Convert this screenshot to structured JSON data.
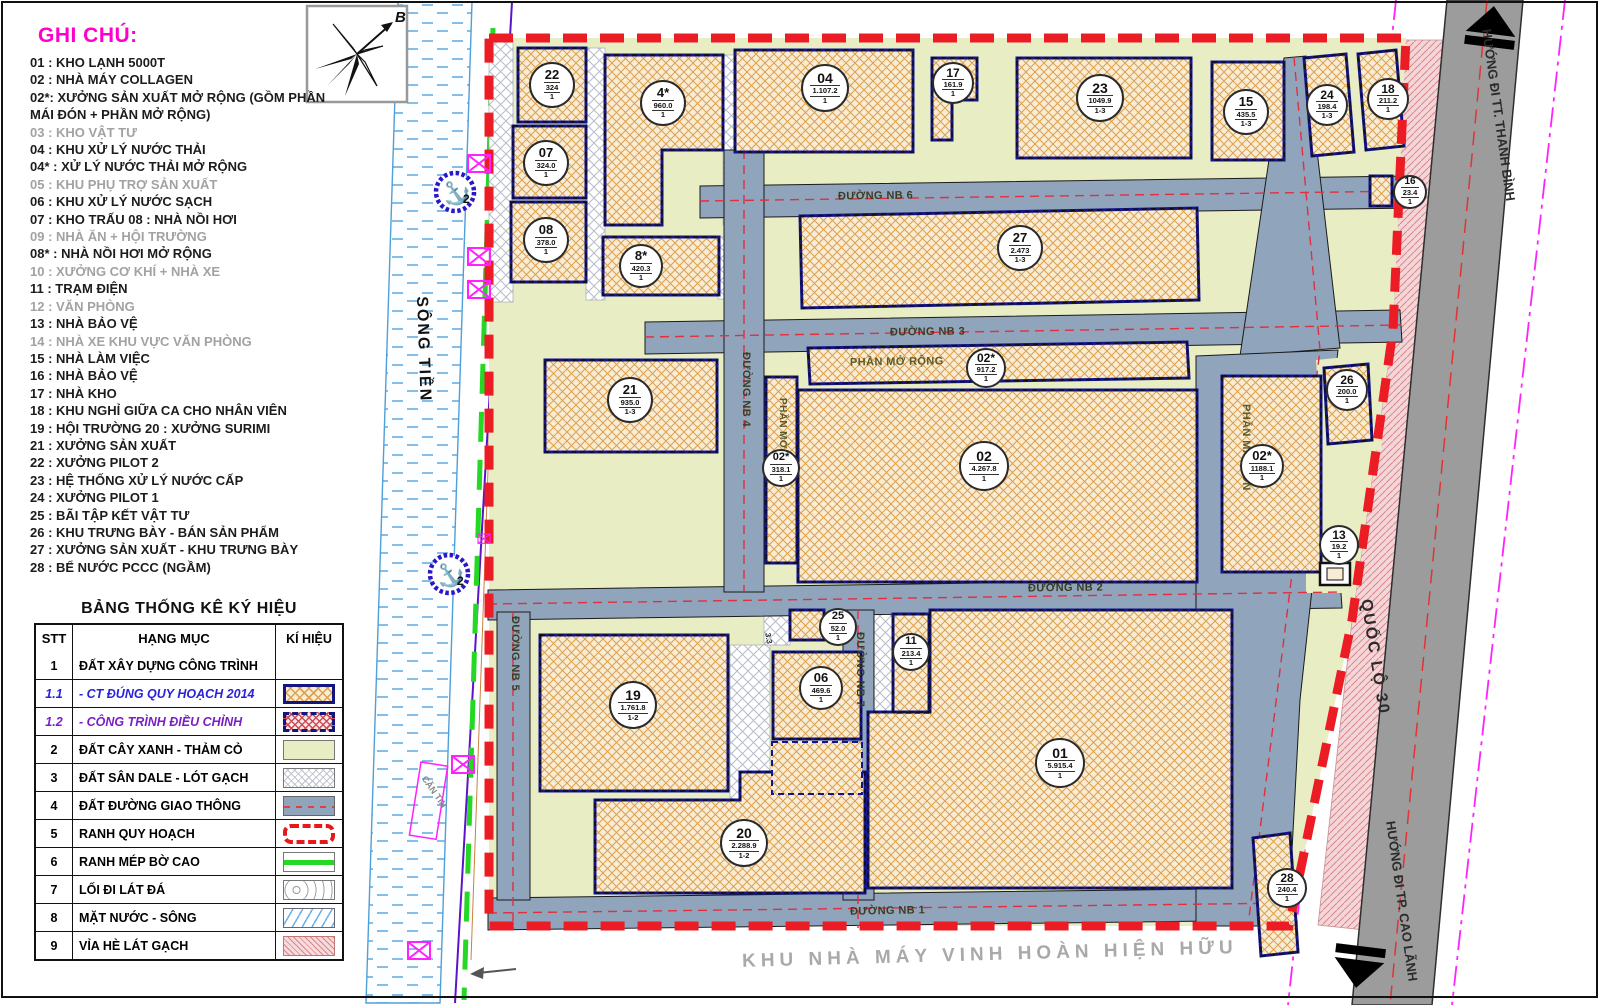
{
  "legend": {
    "title": "GHI CHÚ:",
    "items": [
      {
        "text": "01 : KHO LẠNH 5000T",
        "muted": false
      },
      {
        "text": "02 : NHÀ MÁY COLLAGEN",
        "muted": false
      },
      {
        "text": "02*: XƯỞNG SẢN XUẤT MỞ RỘNG (GỒM PHẦN MÁI ĐÓN + PHẦN MỞ RỘNG)",
        "muted": false
      },
      {
        "text": "03 : KHO VẬT TƯ",
        "muted": true
      },
      {
        "text": "04 : KHU XỬ LÝ NƯỚC THẢI",
        "muted": false
      },
      {
        "text": "04* : XỬ LÝ NƯỚC THẢI MỞ RỘNG",
        "muted": false
      },
      {
        "text": "05 : KHU PHỤ TRỢ SẢN XUẤT",
        "muted": true
      },
      {
        "text": "06 : KHU XỬ LÝ NƯỚC SẠCH",
        "muted": false
      },
      {
        "text": "07 : KHO TRẤU 08 : NHÀ NỒI HƠI",
        "muted": false
      },
      {
        "text": "09 : NHÀ ĂN + HỘI TRƯỜNG",
        "muted": true
      },
      {
        "text": "08* : NHÀ NỒI HƠI MỞ RỘNG",
        "muted": false
      },
      {
        "text": "10 : XƯỞNG CƠ KHÍ + NHÀ XE",
        "muted": true
      },
      {
        "text": "11 : TRẠM ĐIỆN",
        "muted": false
      },
      {
        "text": "12 : VĂN PHÒNG",
        "muted": true
      },
      {
        "text": "13 : NHÀ BẢO VỆ",
        "muted": false
      },
      {
        "text": "14 : NHÀ XE KHU VỰC VĂN PHÒNG",
        "muted": true
      },
      {
        "text": "15 : NHÀ LÀM VIỆC",
        "muted": false
      },
      {
        "text": "16 : NHÀ BẢO VỆ",
        "muted": false
      },
      {
        "text": "17 : NHÀ KHO",
        "muted": false
      },
      {
        "text": "18 : KHU NGHỈ GIỮA CA CHO NHÂN VIÊN",
        "muted": false
      },
      {
        "text": "19 : HỘI TRƯỜNG 20 : XƯỞNG SURIMI",
        "muted": false
      },
      {
        "text": "21 : XƯỞNG SẢN XUẤT",
        "muted": false
      },
      {
        "text": "22 : XƯỞNG PILOT 2",
        "muted": false
      },
      {
        "text": "23 : HỆ THỐNG XỬ LÝ NƯỚC CẤP",
        "muted": false
      },
      {
        "text": "24 : XƯỞNG PILOT 1",
        "muted": false
      },
      {
        "text": "25 : BÃI TẬP KẾT VẬT TƯ",
        "muted": false
      },
      {
        "text": "26 : KHU TRƯNG BÀY - BÁN SẢN PHẨM",
        "muted": false
      },
      {
        "text": "27 : XƯỞNG SẢN XUẤT - KHU TRƯNG BÀY",
        "muted": false
      },
      {
        "text": "28 : BỂ NƯỚC PCCC (NGẦM)",
        "muted": false
      }
    ]
  },
  "table": {
    "title": "BẢNG THỐNG KÊ KÝ HIỆU",
    "headers": {
      "stt": "STT",
      "hangmuc": "HẠNG MỤC",
      "kihieu": "KÍ HIỆU"
    },
    "rows": [
      {
        "stt": "1",
        "label": "ĐẤT XÂY DỰNG CÔNG TRÌNH",
        "swatch": "none",
        "style": ""
      },
      {
        "stt": "1.1",
        "label": "- CT ĐÚNG QUY HOẠCH 2014",
        "swatch": "tan",
        "style": "blue-italic"
      },
      {
        "stt": "1.2",
        "label": "- CÔNG TRÌNH ĐIỀU CHỈNH",
        "swatch": "red",
        "style": "purple-italic"
      },
      {
        "stt": "2",
        "label": "ĐẤT CÂY XANH - THẢM CỎ",
        "swatch": "green",
        "style": ""
      },
      {
        "stt": "3",
        "label": "ĐẤT SÂN DALE - LÓT GẠCH",
        "swatch": "gray",
        "style": ""
      },
      {
        "stt": "4",
        "label": "ĐẤT ĐƯỜNG GIAO THÔNG",
        "swatch": "road",
        "style": ""
      },
      {
        "stt": "5",
        "label": "RANH QUY HOẠCH",
        "swatch": "dash",
        "style": ""
      },
      {
        "stt": "6",
        "label": "RANH MÉP BỜ CAO",
        "swatch": "gline",
        "style": ""
      },
      {
        "stt": "7",
        "label": "LỐI ĐI LÁT ĐÁ",
        "swatch": "stone",
        "style": ""
      },
      {
        "stt": "8",
        "label": "MẶT NƯỚC - SÔNG",
        "swatch": "water",
        "style": ""
      },
      {
        "stt": "9",
        "label": "VỈA HÈ LÁT GẠCH",
        "swatch": "pink",
        "style": ""
      }
    ]
  },
  "buildings": [
    {
      "id": "22",
      "area": "324",
      "floors": "1"
    },
    {
      "id": "07",
      "area": "324.0",
      "floors": "1"
    },
    {
      "id": "08",
      "area": "378.0",
      "floors": "1"
    },
    {
      "id": "4*",
      "area": "960.0",
      "floors": "1"
    },
    {
      "id": "8*",
      "area": "420.3",
      "floors": "1"
    },
    {
      "id": "04",
      "area": "1.107.2",
      "floors": "1"
    },
    {
      "id": "17",
      "area": "161.9",
      "floors": "1"
    },
    {
      "id": "23",
      "area": "1049.9",
      "floors": "1-3"
    },
    {
      "id": "15",
      "area": "435.5",
      "floors": "1-3"
    },
    {
      "id": "24",
      "area": "198.4",
      "floors": "1-3"
    },
    {
      "id": "18",
      "area": "211.2",
      "floors": "1"
    },
    {
      "id": "16",
      "area": "23.4",
      "floors": "1"
    },
    {
      "id": "27",
      "area": "2.473",
      "floors": "1-3"
    },
    {
      "id": "02*",
      "area": "917.2",
      "floors": "1"
    },
    {
      "id": "21",
      "area": "935.0",
      "floors": "1-3"
    },
    {
      "id": "02*",
      "area": "318.1",
      "floors": "1"
    },
    {
      "id": "02",
      "area": "4.267.8",
      "floors": "1"
    },
    {
      "id": "02*",
      "area": "1188.1",
      "floors": "1"
    },
    {
      "id": "26",
      "area": "200.0",
      "floors": "1"
    },
    {
      "id": "13",
      "area": "19.2",
      "floors": "1"
    },
    {
      "id": "25",
      "area": "52.0",
      "floors": "1"
    },
    {
      "id": "11",
      "area": "213.4",
      "floors": "1"
    },
    {
      "id": "06",
      "area": "469.6",
      "floors": "1"
    },
    {
      "id": "19",
      "area": "1.761.8",
      "floors": "1-2"
    },
    {
      "id": "20",
      "area": "2.288.9",
      "floors": "1-2"
    },
    {
      "id": "01",
      "area": "5.915.4",
      "floors": "1"
    },
    {
      "id": "28",
      "area": "240.4",
      "floors": "1"
    }
  ],
  "roads": {
    "nb1": "ĐƯỜNG NB 1",
    "nb2": "ĐƯỜNG NB 2",
    "nb3": "ĐƯỜNG NB 3",
    "nb4": "ĐƯỜNG NB 4",
    "nb5": "ĐƯỜNG NB 5",
    "nb6": "ĐƯỜNG NB 6",
    "nb7": "ĐƯỜNG NB 7"
  },
  "plan": {
    "north": "B",
    "river": "SÔNG TIỀN",
    "highway": "QUỐC LỘ 30",
    "dir_north": "HƯỚNG ĐI TT. THANH BÌNH",
    "dir_south": "HƯỚNG ĐI TP. CAO LÃNH",
    "existing": "KHU NHÀ MÁY VINH HOÀN HIỆN HỮU",
    "extension_top": "PHẦN MỞ RỘNG",
    "extension_left": "PHẦN MỞ RỘNG",
    "canopy": "PHẦN MÁI ĐÓN",
    "canteen": "CĂN TIN",
    "anchor_no": "2",
    "small_mark": "3.3"
  },
  "colors": {
    "green_land": "#e8edc3",
    "road": "#90a4bc",
    "building_fill": "#f8ecd4",
    "building_hatch": "#dca04e",
    "building_stroke": "#15158a",
    "boundary_red": "#ec1c24",
    "highway_gray": "#9c9c9c",
    "sidewalk_pink": "#f4d6d8",
    "magenta": "#ff22ff",
    "bank_green": "#25d825",
    "water_blue": "#5fa8e0",
    "legend_title": "#ff00cc"
  }
}
